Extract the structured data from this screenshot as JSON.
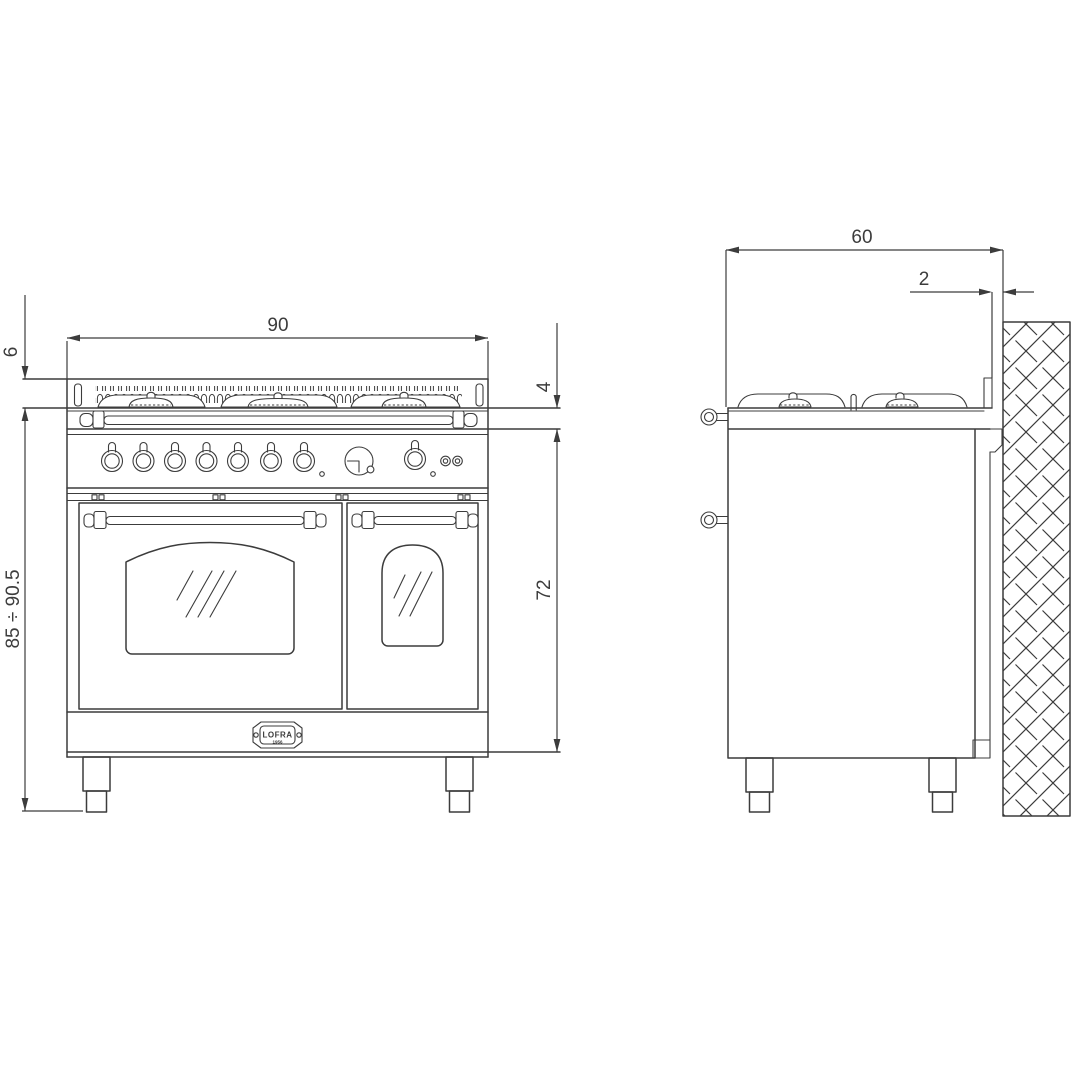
{
  "colors": {
    "line": "#3c3c3c",
    "background": "#ffffff"
  },
  "front_view": {
    "dimensions": {
      "width": "90",
      "pan_support_height": "6",
      "hob_rim_height": "4",
      "overall_height": "85 ÷ 90.5",
      "body_height": "72"
    },
    "badge": {
      "brand": "LOFRA",
      "subtext": "1956"
    },
    "controls": {
      "knob_count": 7,
      "oven_knob_count": 1,
      "indicator_light_count": 2
    }
  },
  "side_view": {
    "dimensions": {
      "depth": "60",
      "wall_clearance": "2"
    }
  }
}
